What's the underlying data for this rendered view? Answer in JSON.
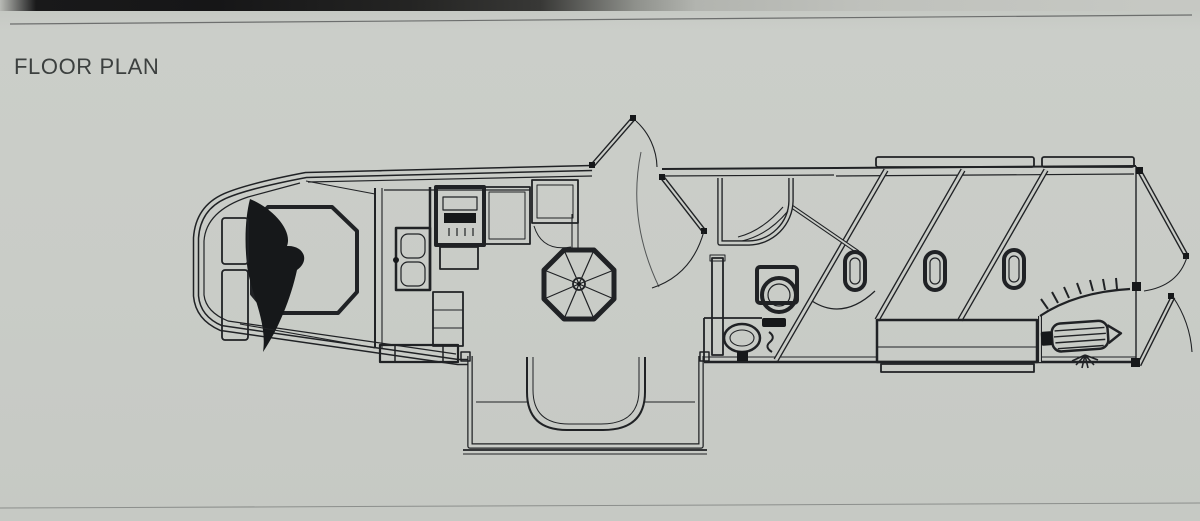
{
  "page": {
    "background": "#c9ccc7",
    "line_color": "#202225"
  },
  "header": {
    "title": "FLOOR PLAN",
    "color": "#3c403f"
  },
  "floor_plan": {
    "type": "diagram",
    "subject": "living-quarters horse trailer floor plan, top view, no text labels",
    "areas": [
      {
        "name": "gooseneck-bedroom",
        "features": [
          "bed",
          "blanket",
          "side-cabinets",
          "wardrobe-wall"
        ]
      },
      {
        "name": "kitchen",
        "features": [
          "range-stove",
          "oven",
          "double-sink",
          "refrigerator",
          "pantry-cabinet",
          "entry-steps"
        ]
      },
      {
        "name": "dinette",
        "features": [
          "octagonal-pedestal-table",
          "u-shaped-sofa-slideout"
        ]
      },
      {
        "name": "entry",
        "features": [
          "entry-door-open",
          "interior-door-open"
        ]
      },
      {
        "name": "bathroom",
        "features": [
          "corner-shower",
          "toilet",
          "vanity-sink",
          "linen-cabinet"
        ]
      },
      {
        "name": "horse-area",
        "features": [
          "slant-stall-dividers",
          "drop-down-window-ovals",
          "wheel-well-bench",
          "stall-gate-arc"
        ]
      },
      {
        "name": "rear-tack",
        "features": [
          "saddle-rack",
          "bridle-hook-rail",
          "hook-fan",
          "rear-doors-open"
        ]
      }
    ]
  }
}
